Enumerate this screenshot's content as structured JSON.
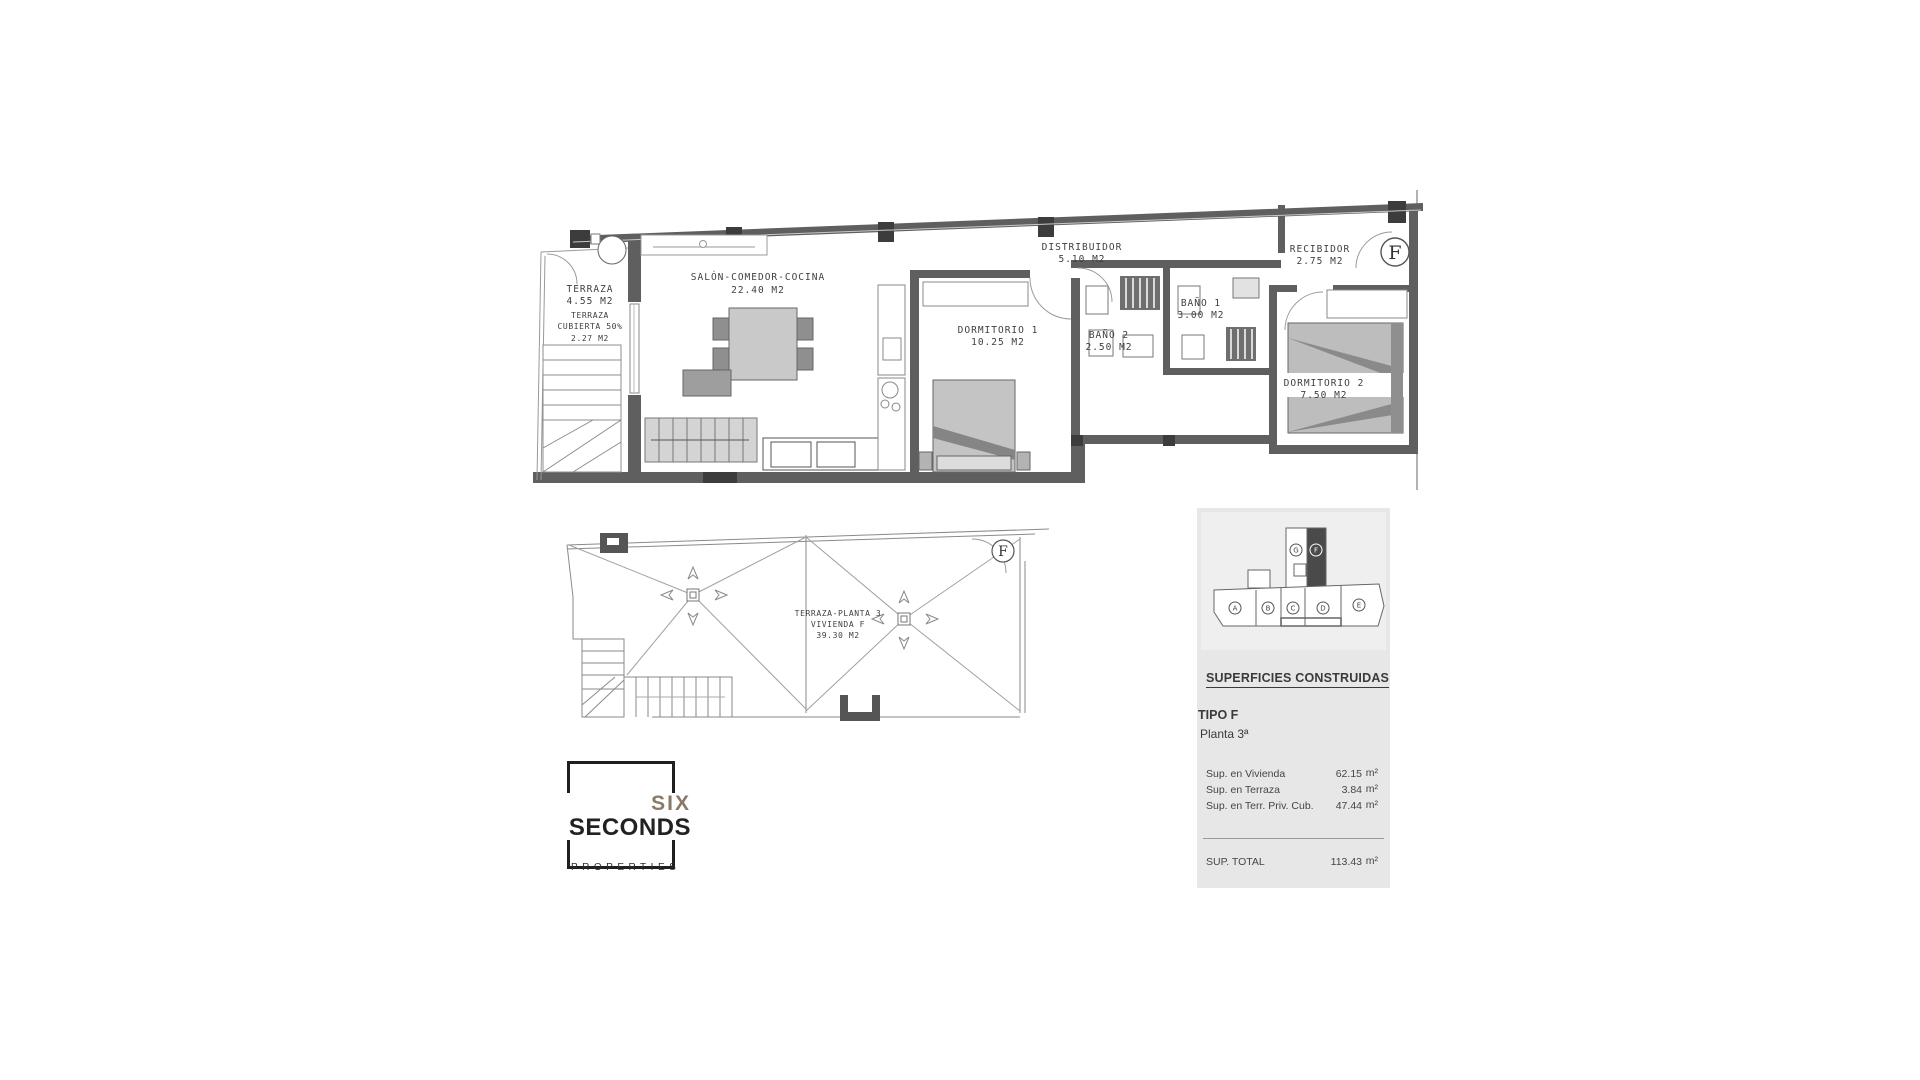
{
  "colors": {
    "wall": "#5f5f5f",
    "column": "#3c3c3c",
    "panel_bg": "#e7e7e7",
    "logo_six": "#8a7a68",
    "plan_text": "#3f3f3f"
  },
  "upper_plan": {
    "unit_marker": "F",
    "rooms": {
      "terraza": {
        "l1": "TERRAZA",
        "l2": "4.55 M2",
        "l3": "TERRAZA",
        "l4": "CUBIERTA 50%",
        "l5": "2.27 M2"
      },
      "salon": {
        "l1": "SALÓN-COMEDOR-COCINA",
        "l2": "22.40 M2"
      },
      "dormitorio1": {
        "l1": "DORMITORIO 1",
        "l2": "10.25 M2"
      },
      "bano2": {
        "l1": "BAÑO 2",
        "l2": "2.50 M2"
      },
      "distribuidor": {
        "l1": "DISTRIBUIDOR",
        "l2": "5.10 M2"
      },
      "bano1": {
        "l1": "BAÑO 1",
        "l2": "3.00 M2"
      },
      "recibidor": {
        "l1": "RECIBIDOR",
        "l2": "2.75 M2"
      },
      "dormitorio2": {
        "l1": "DORMITORIO 2",
        "l2": "7.50 M2"
      }
    }
  },
  "lower_plan": {
    "unit_marker": "F",
    "label": {
      "l1": "TERRAZA-PLANTA 3",
      "l2": "VIVIENDA F",
      "l3": "39.30 M2"
    }
  },
  "logo": {
    "line1": "SIX",
    "line2": "SECONDS",
    "line3": "PROPERTIES"
  },
  "key_plan": {
    "units": [
      "A",
      "B",
      "C",
      "D",
      "E",
      "G"
    ],
    "highlighted": "F"
  },
  "surfaces_panel": {
    "title": "SUPERFICIES CONSTRUIDAS",
    "tipo": "TIPO F",
    "planta": "Planta 3ª",
    "rows": [
      {
        "label": "Sup. en  Vivienda",
        "value": "62.15",
        "unit": "m²"
      },
      {
        "label": "Sup. en  Terraza",
        "value": "3.84",
        "unit": "m²"
      },
      {
        "label": "Sup. en Terr. Priv. Cub.",
        "value": "47.44",
        "unit": "m²"
      }
    ],
    "total_label": "SUP. TOTAL",
    "total_value": "113.43",
    "total_unit": "m²"
  }
}
